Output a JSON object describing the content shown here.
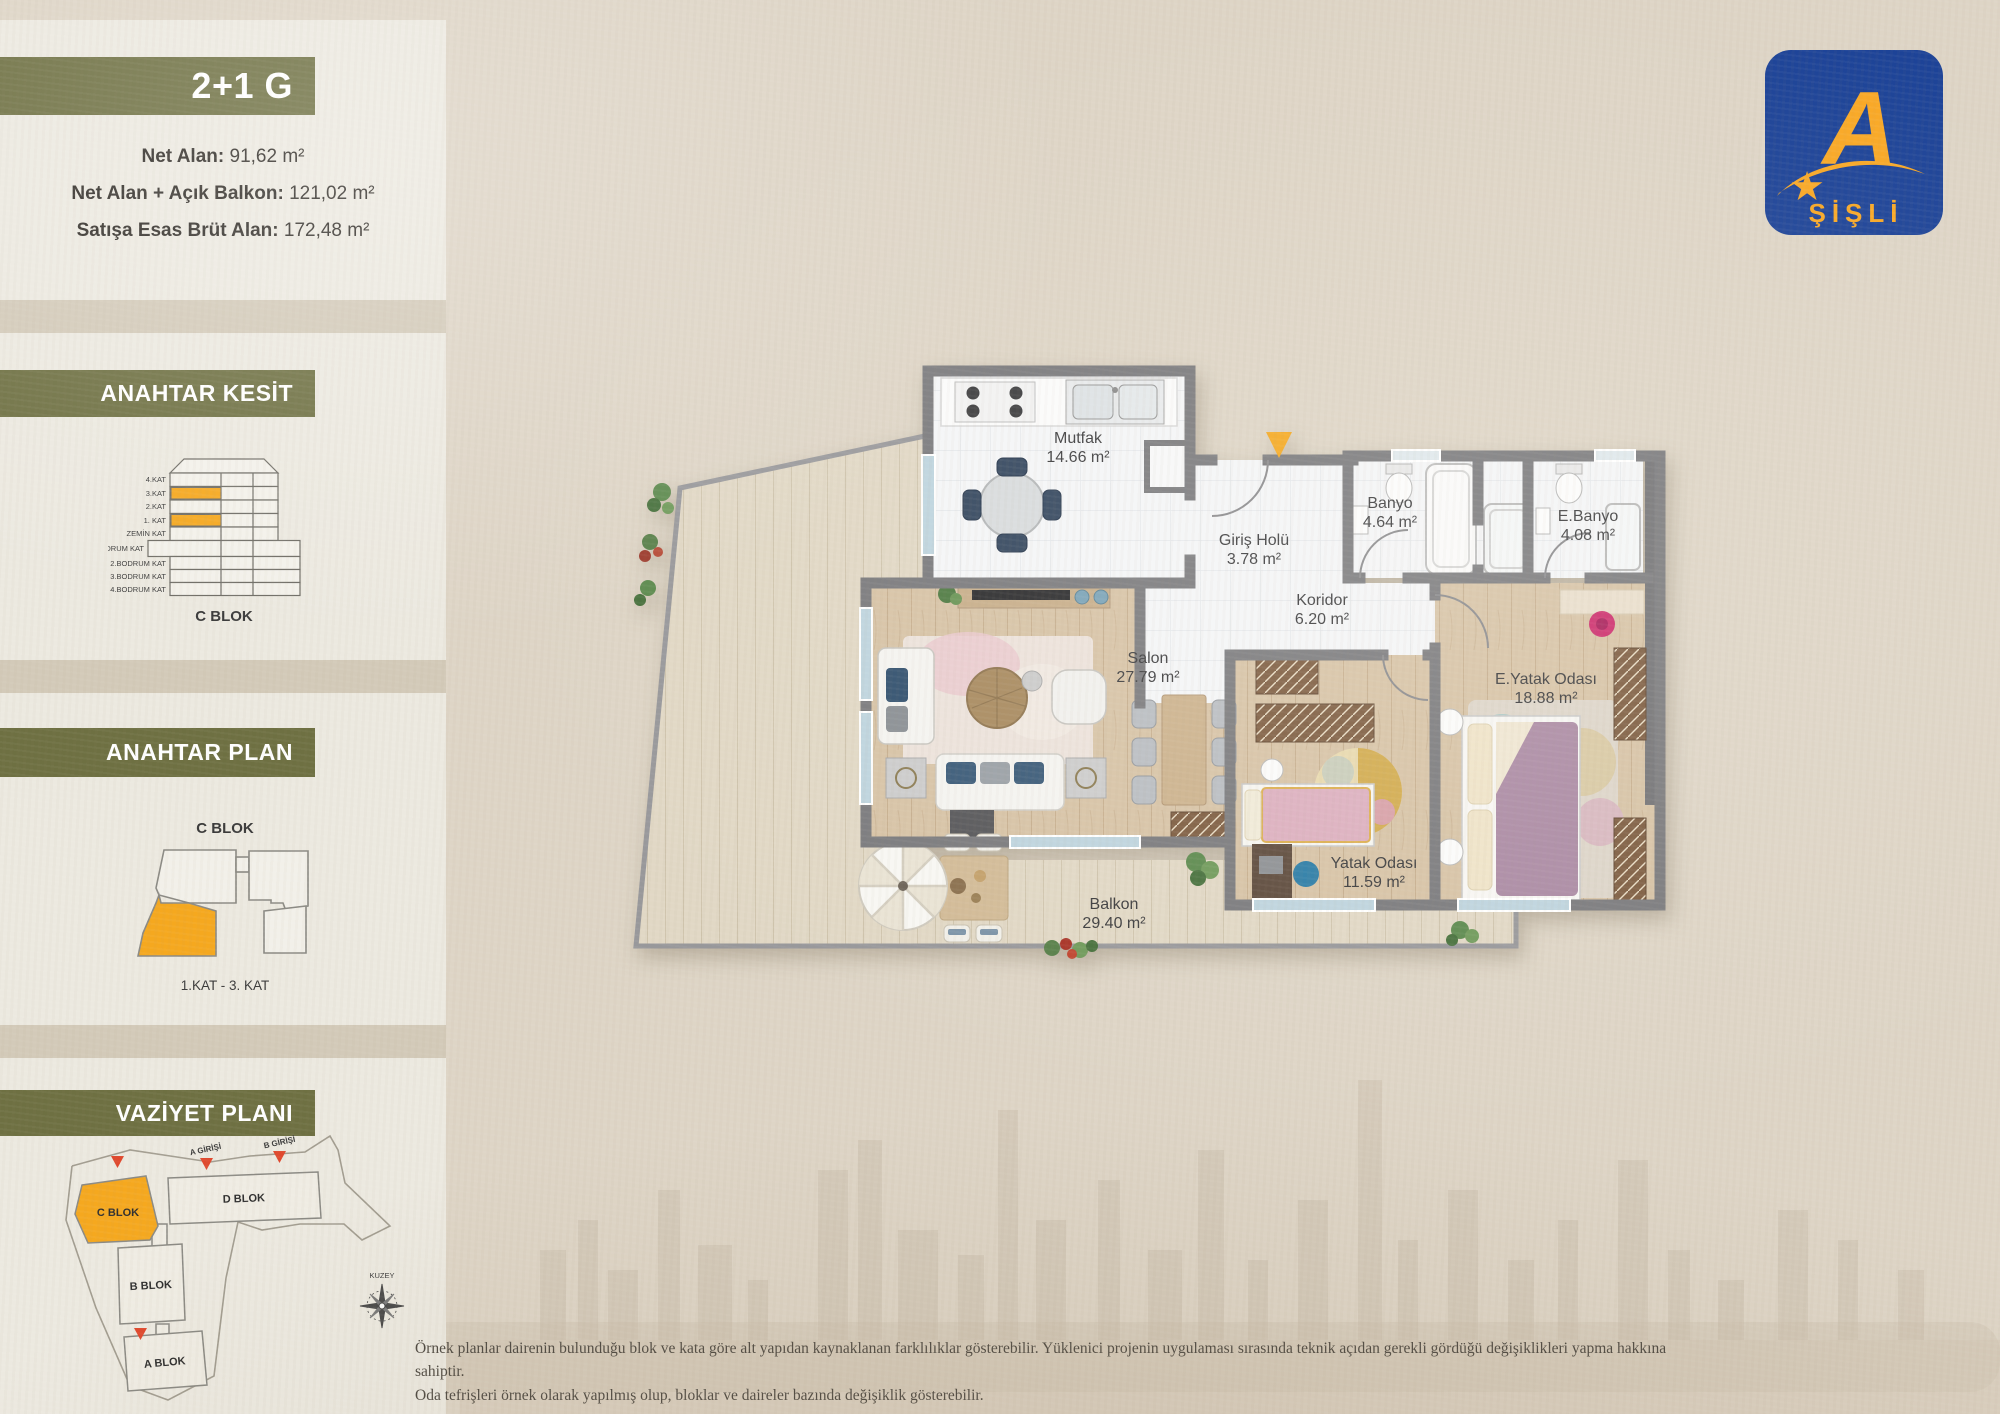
{
  "header": {
    "unit_type": "2+1 G",
    "stats": [
      {
        "label": "Net Alan:",
        "value": "91,62 m²"
      },
      {
        "label": "Net Alan + Açık Balkon:",
        "value": "121,02 m²"
      },
      {
        "label": "Satışa Esas Brüt Alan:",
        "value": "172,48 m²"
      }
    ]
  },
  "logo": {
    "letter": "A",
    "brand": "ŞİŞLİ"
  },
  "sections": {
    "kesit": {
      "title": "ANAHTAR KESİT",
      "floors": [
        "4.KAT",
        "3.KAT",
        "2.KAT",
        "1. KAT",
        "ZEMİN KAT",
        "1.BODRUM KAT",
        "2.BODRUM KAT",
        "3.BODRUM KAT",
        "4.BODRUM KAT"
      ],
      "block": "C BLOK"
    },
    "plan": {
      "title": "ANAHTAR PLAN",
      "block": "C BLOK",
      "floors": "1.KAT - 3. KAT"
    },
    "vaziyet": {
      "title": "VAZİYET PLANI",
      "blocks": {
        "a": "A BLOK",
        "b": "B BLOK",
        "c": "C BLOK",
        "d": "D BLOK"
      },
      "entrances": {
        "a": "A GİRİŞİ",
        "b": "B GİRİŞİ"
      },
      "compass": "KUZEY"
    }
  },
  "floorplan": {
    "rooms": {
      "mutfak": {
        "name": "Mutfak",
        "area": "14.66 m²"
      },
      "giris": {
        "name": "Giriş Holü",
        "area": "3.78 m²"
      },
      "koridor": {
        "name": "Koridor",
        "area": "6.20 m²"
      },
      "banyo": {
        "name": "Banyo",
        "area": "4.64 m²"
      },
      "ebanyo": {
        "name": "E.Banyo",
        "area": "4.08 m²"
      },
      "salon": {
        "name": "Salon",
        "area": "27.79 m²"
      },
      "eyatak": {
        "name": "E.Yatak Odası",
        "area": "18.88 m²"
      },
      "yatak": {
        "name": "Yatak Odası",
        "area": "11.59 m²"
      },
      "balkon": {
        "name": "Balkon",
        "area": "29.40 m²"
      }
    }
  },
  "disclaimer": {
    "line1": "Örnek planlar dairenin bulunduğu blok ve kata göre alt yapıdan kaynaklanan farklılıklar gösterebilir. Yüklenici projenin uygulaması sırasında teknik açıdan gerekli gördüğü değişiklikleri yapma hakkına sahiptir.",
    "line2": "Oda tefrişleri örnek olarak yapılmış olup, bloklar ve daireler bazında değişiklik gösterebilir."
  },
  "colors": {
    "accent_olive": "#6e7042",
    "accent_orange": "#f5a81f",
    "logo_blue": "#1d4397",
    "logo_yellow": "#f9a825",
    "wall_gray": "#7a7a7d"
  }
}
